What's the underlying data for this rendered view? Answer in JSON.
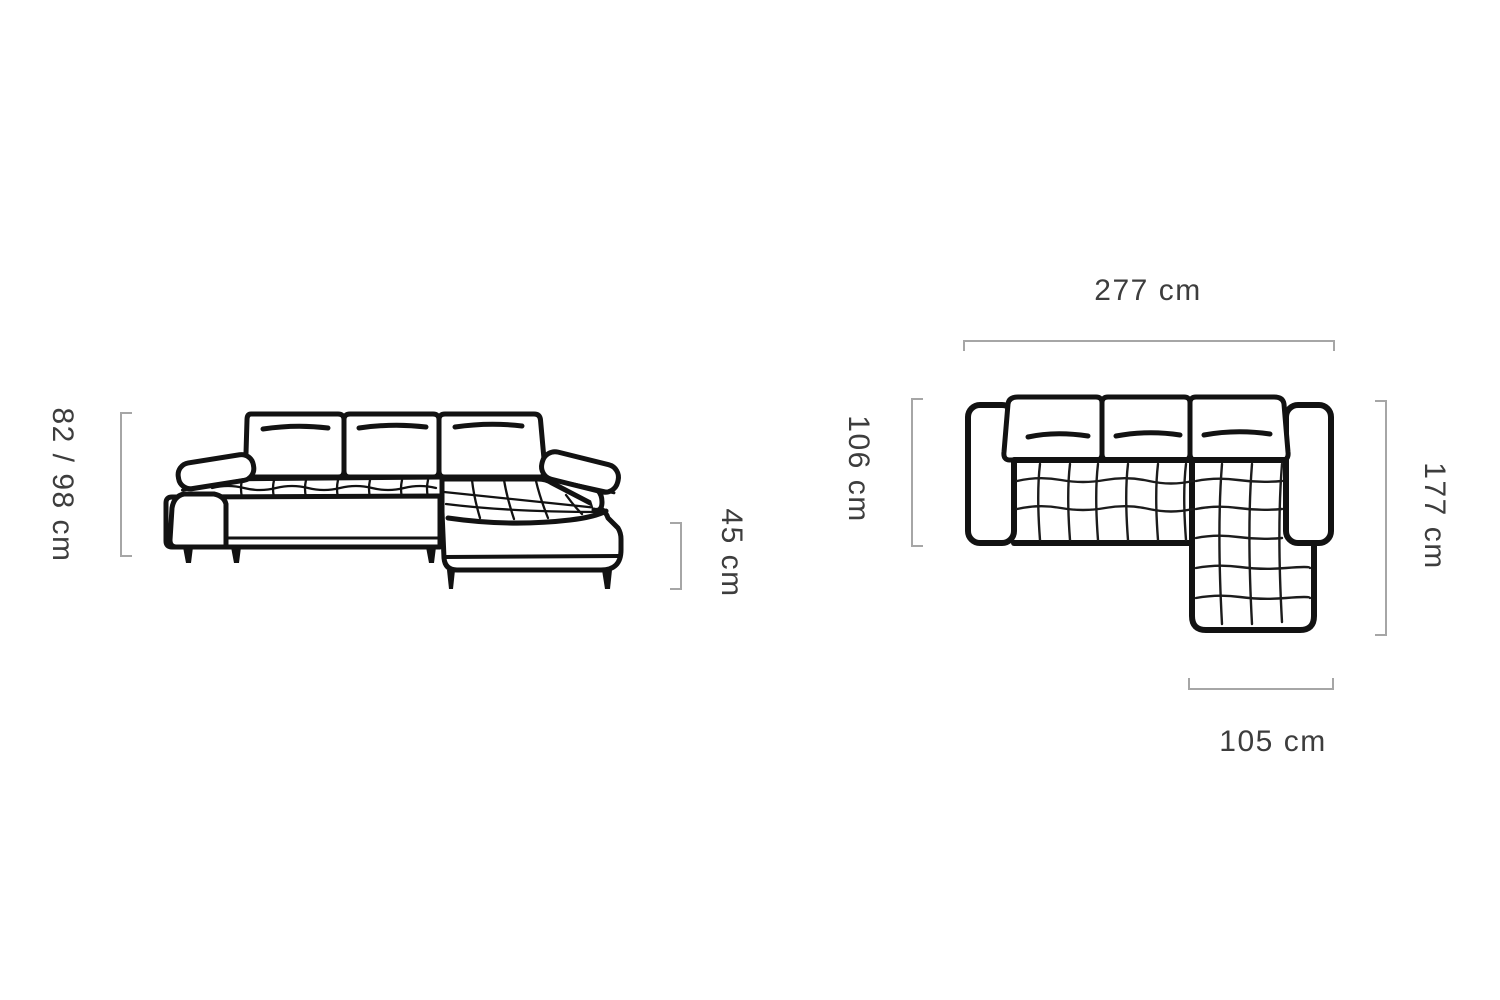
{
  "front_view": {
    "name": "sofa front elevation view",
    "height_label": "82 / 98 cm",
    "seat_height_label": "45 cm"
  },
  "top_view": {
    "name": "sofa top plan view",
    "width_label": "277 cm",
    "depth_label": "106 cm",
    "length_label": "177 cm",
    "chaise_width_label": "105 cm"
  },
  "colors": {
    "line": "#121212",
    "tuft_grid": "#1c1c1c",
    "dimension_bracket": "#a6a6a6",
    "label_text": "#3d3d3d",
    "background": "#ffffff"
  }
}
